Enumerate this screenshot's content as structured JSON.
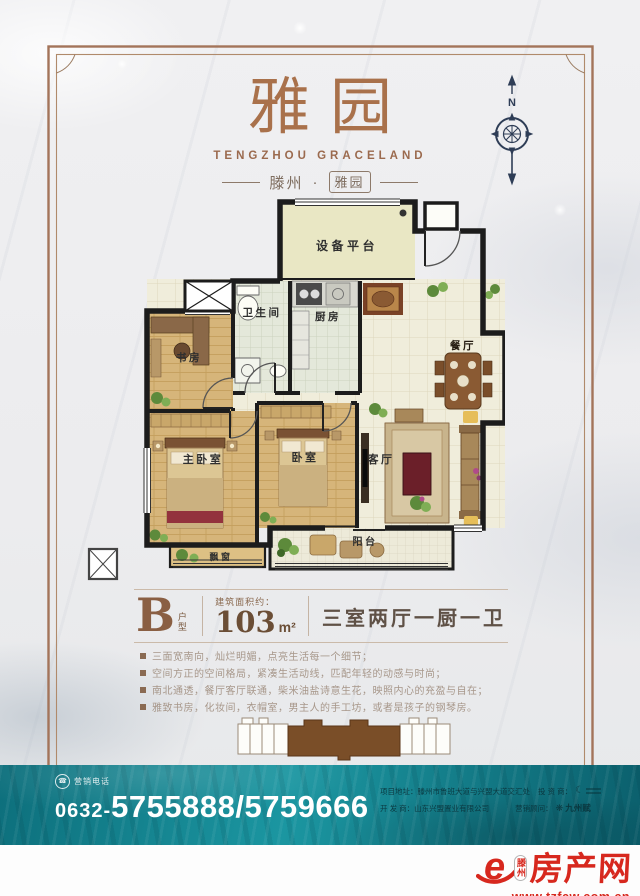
{
  "colors": {
    "brand_brown": "#a9714b",
    "wall_black": "#1c1c1c",
    "teal": "#117f8c",
    "logo_red": "#d7281e"
  },
  "header": {
    "brand": "雅园",
    "brand_en": "TENGZHOU GRACELAND",
    "sub_city": "滕州",
    "sub_dot": "·",
    "sub_name": "雅园",
    "compass_n": "N"
  },
  "floorplan": {
    "rooms": {
      "equipment": "设备平台",
      "bathroom": "卫生间",
      "kitchen": "厨房",
      "study": "书房",
      "dining": "餐厅",
      "master_bedroom": "主卧室",
      "bedroom": "卧室",
      "living": "客厅",
      "balcony": "阳台",
      "bay_window": "飘窗"
    }
  },
  "spec": {
    "type_letter": "B",
    "type_label": "户型",
    "area_label": "建筑面积约：",
    "area_value": "103",
    "area_unit": "m²",
    "rooms_text": "三室两厅一厨一卫"
  },
  "features": [
    "三面宽南向，灿烂明媚，点亮生活每一个细节；",
    "空间方正的空间格局，紧凑生活动线，匹配年轻的动感与时尚；",
    "南北通透，餐厅客厅联通，柴米油盐诗意生花，映照内心的充盈与自在；",
    "雅致书房，化妆间，衣帽室，男主人的手工坊，或者是孩子的钢琴房。"
  ],
  "contact": {
    "phone_label": "营销电话",
    "phone_prefix": "0632-",
    "phone_number": "5755888/5759666",
    "address_label": "项目地址：",
    "address_value": "滕州市鲁班大道与兴盟大道交汇处",
    "investor_label": "投 资 商：",
    "developer_label": "开 发 商：",
    "developer_value": "山东兴盟置业有限公司",
    "consultant_label": "营销顾问：",
    "consultant_value": "九州赋"
  },
  "footer": {
    "site_city": "滕州",
    "site_name": "房产网",
    "site_url": "www.tzfcw.com.cn"
  }
}
